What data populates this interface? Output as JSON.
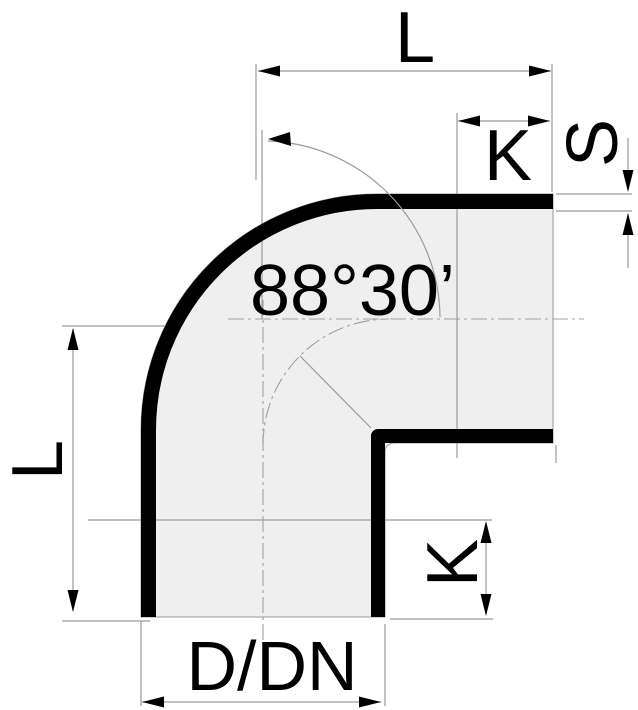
{
  "drawing": {
    "type_label": "pipe-elbow-bend-technical-drawing",
    "angle": {
      "label": "88°30’"
    },
    "dimensions": {
      "length_top": "L",
      "socket_depth_top": "K",
      "wall_thickness": "S",
      "length_left": "L",
      "socket_depth_bottom": "K",
      "diameter": "D/DN"
    },
    "colors": {
      "background": "#ffffff",
      "body_fill": "#efefef",
      "construction_line": "#9a9a9a",
      "ink": "#000000"
    }
  }
}
